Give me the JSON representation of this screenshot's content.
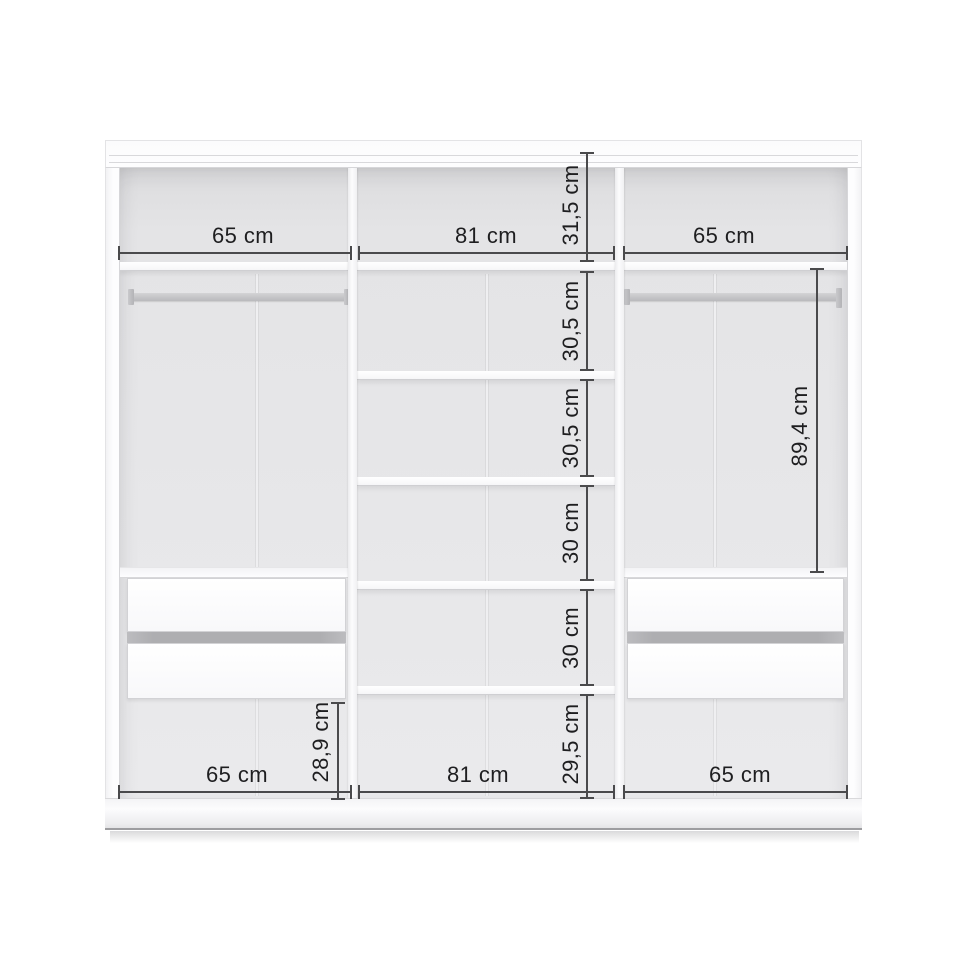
{
  "diagram": {
    "subject": "wardrobe-interior-dimension-diagram",
    "unit": "cm",
    "dims": {
      "top_widths": [
        {
          "label": "65 cm"
        },
        {
          "label": "81 cm"
        },
        {
          "label": "65 cm"
        }
      ],
      "bottom_widths": [
        {
          "label": "65 cm"
        },
        {
          "label": "81 cm"
        },
        {
          "label": "65 cm"
        }
      ],
      "middle_column_heights": [
        {
          "label": "31,5 cm"
        },
        {
          "label": "30,5 cm"
        },
        {
          "label": "30,5 cm"
        },
        {
          "label": "30 cm"
        },
        {
          "label": "30 cm"
        },
        {
          "label": "29,5 cm"
        }
      ],
      "right_section_height": {
        "label": "89,4 cm"
      },
      "left_under_drawer_height": {
        "label": "28,9 cm"
      }
    },
    "structure": {
      "sections": 3,
      "middle_shelves": 5,
      "hanging_rails": 2,
      "drawers_per_side_section": 2
    },
    "colors": {
      "dimension_line": "#4a4a4c",
      "dimension_text": "#1e1e20",
      "carcass_white": "#fcfcfd",
      "interior_back": "#e6e6e8",
      "rail_gray": "#bcbcbe",
      "drawer_gap_gray": "#aeaeb1",
      "background": "#ffffff"
    }
  }
}
